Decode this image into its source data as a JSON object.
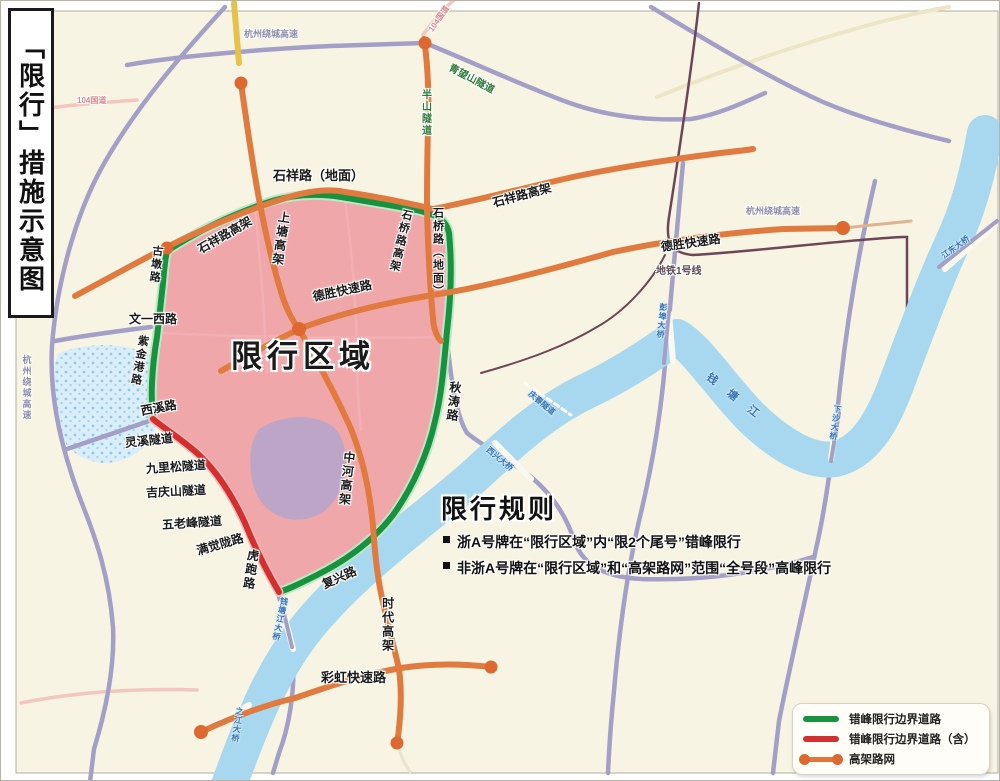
{
  "title": {
    "text": "「限行」措施示意图"
  },
  "zone": {
    "label": "限行区域",
    "fill_color": "#efa2a7"
  },
  "rules": {
    "title": "限行规则",
    "items": [
      "浙A号牌在“限行区域”内“限2个尾号”错峰限行",
      "非浙A号牌在“限行区域”和“高架路网”范围“全号段”高峰限行"
    ]
  },
  "legend": {
    "items": [
      {
        "label": "错峰限行边界道路",
        "color": "#18923f",
        "style": "green-line"
      },
      {
        "label": "错峰限行边界道路（含）",
        "color": "#d42f2f",
        "style": "red-line"
      },
      {
        "label": "高架路网",
        "color": "#e0763b",
        "style": "orange-line-with-dots"
      }
    ]
  },
  "map_labels": [
    {
      "text": "石祥路（地面）"
    },
    {
      "text": "石祥路高架"
    },
    {
      "text": "石祥路高架"
    },
    {
      "text": "上塘高架"
    },
    {
      "text": "石桥路高架"
    },
    {
      "text": "石桥路（地面）"
    },
    {
      "text": "德胜快速路"
    },
    {
      "text": "德胜快速路"
    },
    {
      "text": "古墩路"
    },
    {
      "text": "文一西路"
    },
    {
      "text": "紫金港路"
    },
    {
      "text": "西溪路"
    },
    {
      "text": "灵溪隧道"
    },
    {
      "text": "九里松隧道"
    },
    {
      "text": "吉庆山隧道"
    },
    {
      "text": "五老峰隧道"
    },
    {
      "text": "满觉陇路"
    },
    {
      "text": "虎跑路"
    },
    {
      "text": "复兴路"
    },
    {
      "text": "中河高架"
    },
    {
      "text": "时代高架"
    },
    {
      "text": "彩虹快速路"
    },
    {
      "text": "秋涛路"
    },
    {
      "text": "半山隧道"
    },
    {
      "text": "青望山隧道"
    },
    {
      "text": "地铁1号线"
    },
    {
      "text": "杭州绕城高速"
    },
    {
      "text": "杭州绕城高速"
    },
    {
      "text": "杭州绕城高速"
    },
    {
      "text": "104国道"
    },
    {
      "text": "104国道"
    },
    {
      "text": "钱 塘 江"
    },
    {
      "text": "钱塘江大桥"
    },
    {
      "text": "之江大桥"
    },
    {
      "text": "西兴大桥"
    },
    {
      "text": "庆春隧道"
    },
    {
      "text": "彭埠大桥"
    },
    {
      "text": "下沙大桥"
    },
    {
      "text": "江东大桥"
    }
  ],
  "colors": {
    "background": "#f7f4e3",
    "river": "#a7d8f0",
    "ordinary_road": "#a39fc6",
    "elevated_road": "#e07a3e",
    "boundary_green": "#18923f",
    "boundary_red": "#d42f2f",
    "restricted_zone_fill": "#efa2a7",
    "metro_line": "#6e4656"
  }
}
